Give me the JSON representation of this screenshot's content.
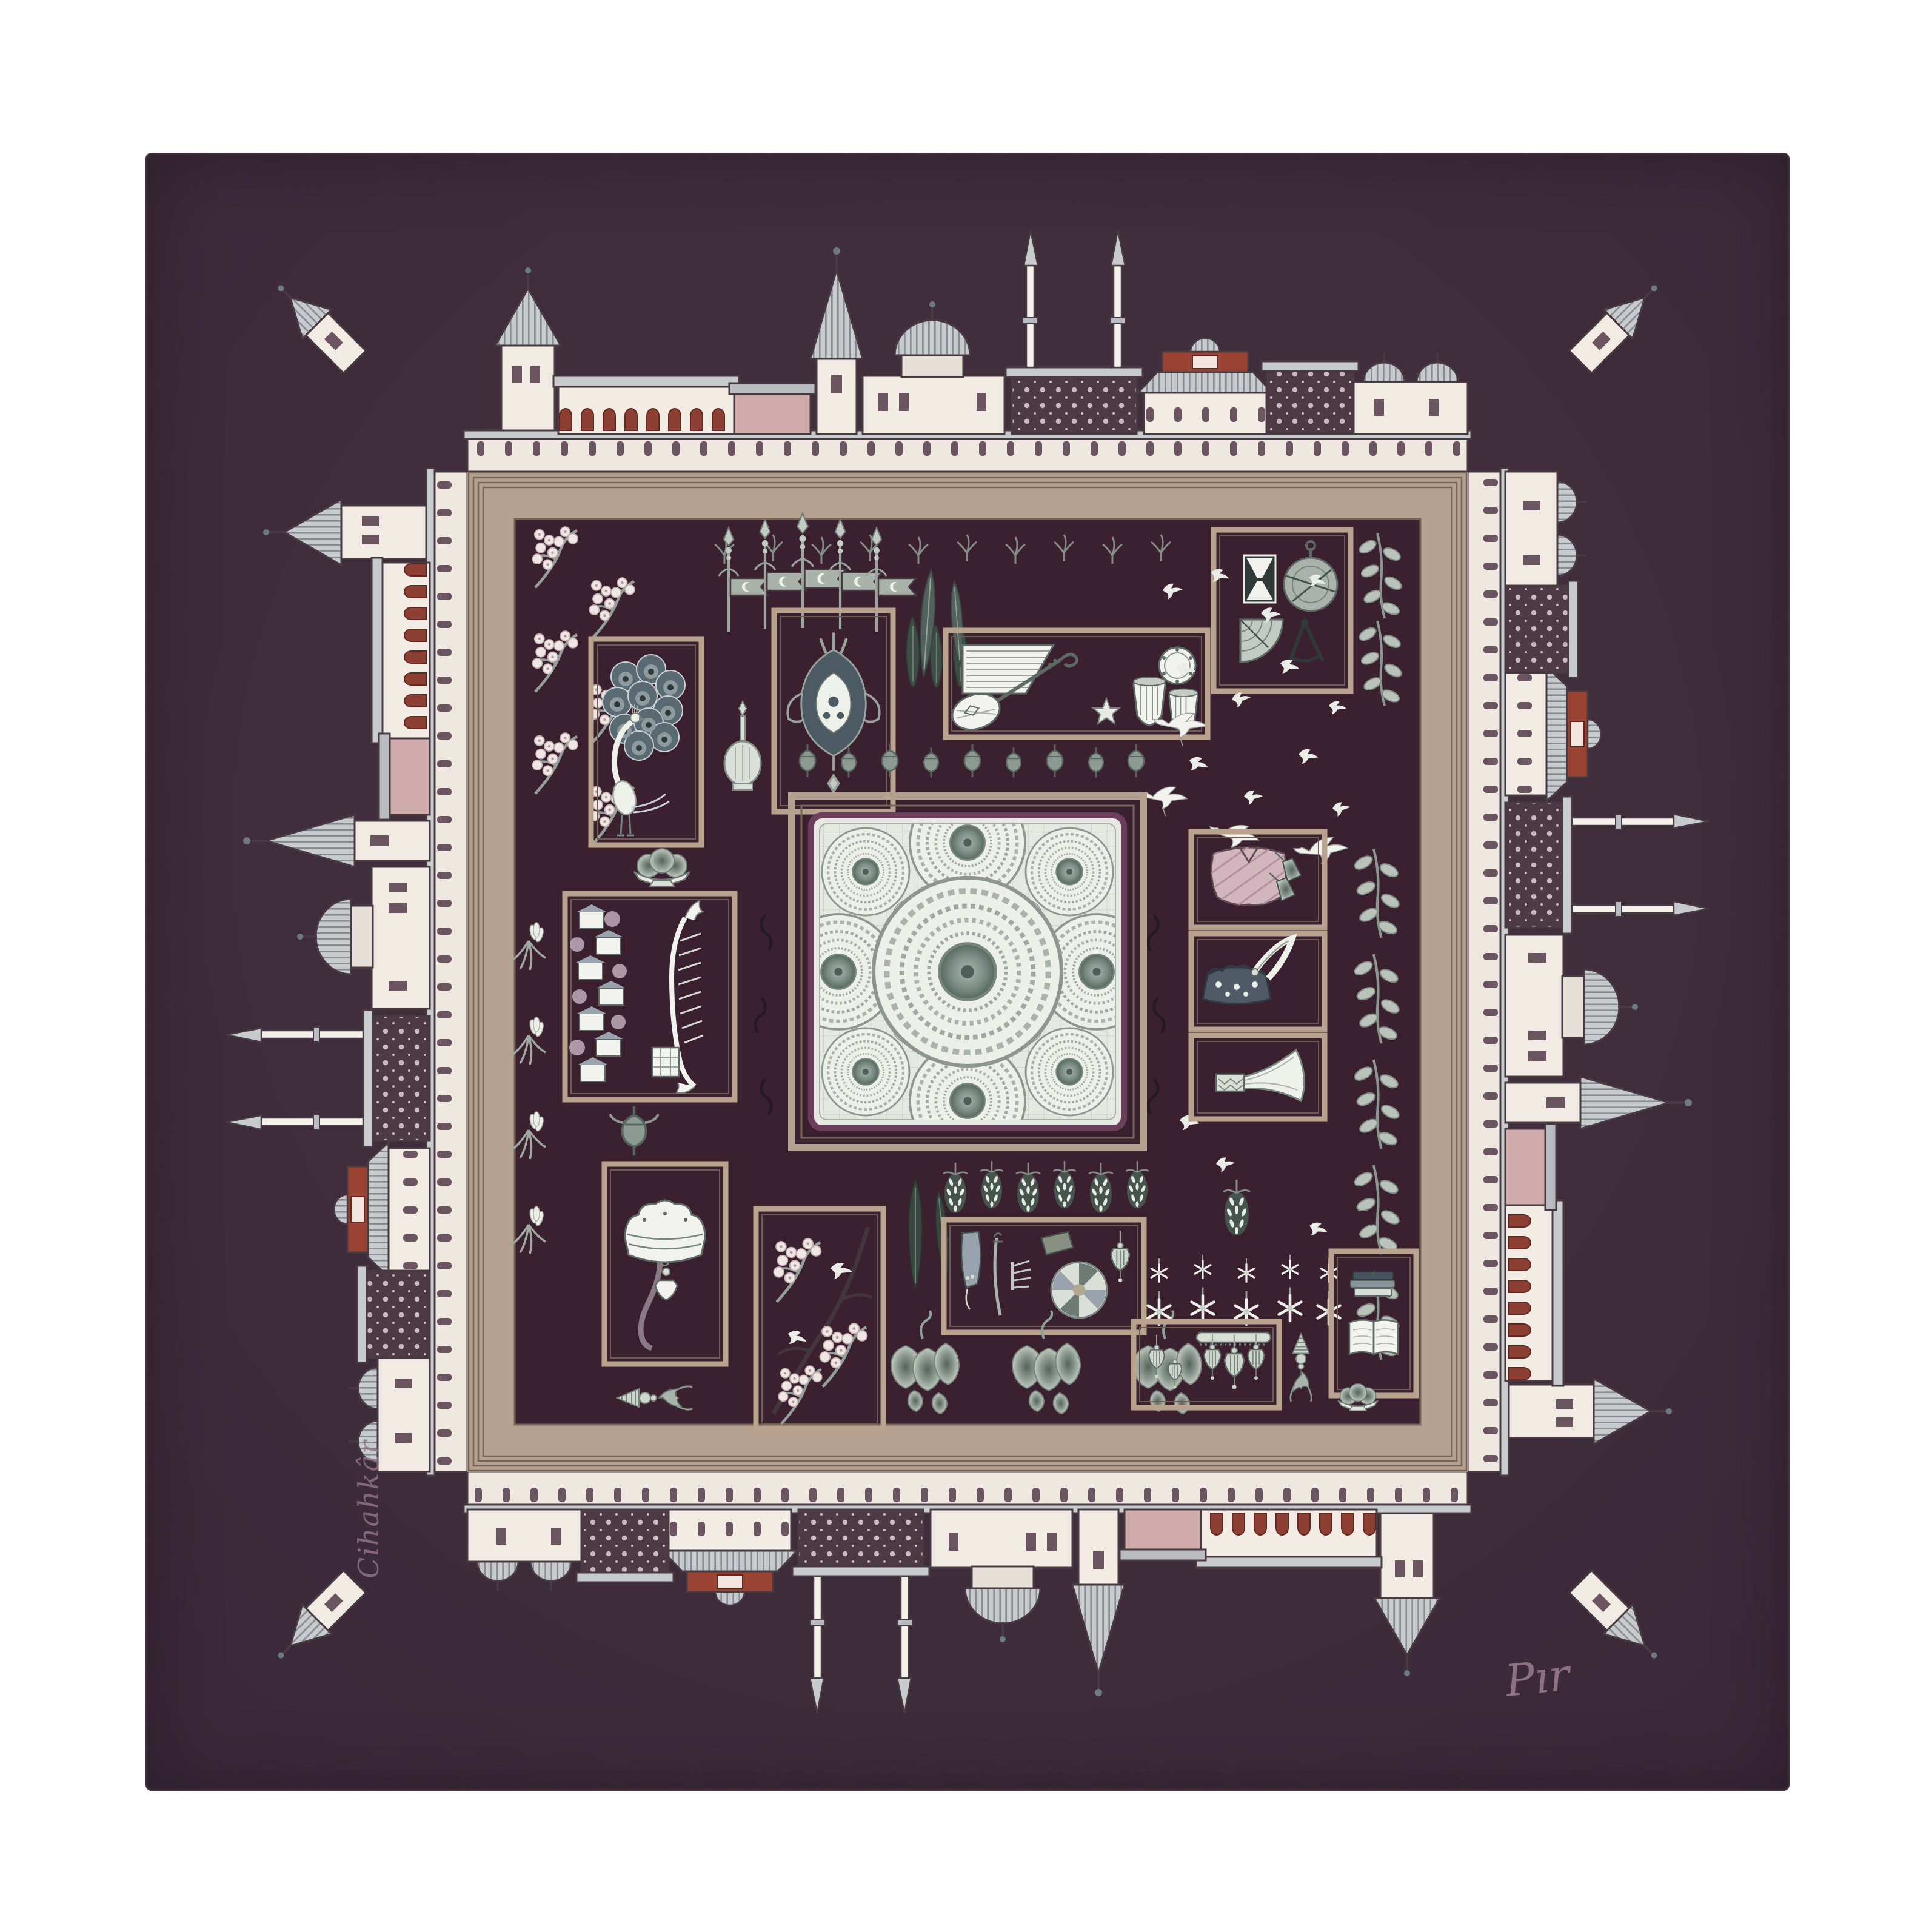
{
  "page": {
    "background_color": "#ffffff",
    "subject": "Product photograph of a square silk twill scarf laid flat on a white background",
    "theme": "Ottoman Istanbul miniature print: palace architecture border, framed Topkapi motifs, central dome-mosaic medallion"
  },
  "scarf": {
    "base_color": "#3f2d3b",
    "inner_field_color": "#3a2230",
    "frame_color": "#b5a090",
    "frame_line_color": "#776557",
    "palette": {
      "ivory": "#f1ebe3",
      "roof_grey": "#c7cbce",
      "outline": "#473a40",
      "dusty_pink": "#cfabab",
      "brick_red": "#9c4434",
      "dark_lattice": "#4e3a45",
      "pale_motif": "#e9ece5",
      "sage_grey": "#9aa59d",
      "teal_core": "#5d716b",
      "signature_mauve": "#96798c",
      "medallion_border_purple": "#6b3f5c",
      "medallion_field": "#e6e8e2"
    },
    "border_architecture": [
      "conical-roof towers",
      "pencil minarets",
      "ribbed domes",
      "tiled kiosks",
      "arched arcades",
      "brick half-dome",
      "lattice facades"
    ],
    "motif_boxes": [
      "peacock",
      "tulip-palmette-medallion",
      "musical-instruments",
      "astronomy-instruments",
      "kaftan-robe",
      "crown-with-aigrette",
      "ceremonial-horn",
      "bosphorus-waterfront-and-caique",
      "fountain-canopy",
      "spring-blossom-and-birds",
      "weapons-and-pinwheel",
      "mosque-lamps",
      "books"
    ],
    "scatter_motifs": [
      "blossom-sprigs",
      "ottoman-standards-with-crescent-flags",
      "cypress-trees",
      "swallows",
      "cranes",
      "rose-sprigs",
      "crocus-flowers",
      "dome-buds-row",
      "hop-clusters",
      "hanging-star-flowers",
      "leaf-clusters",
      "long-leaves",
      "fruit-bowl",
      "rosewater-flask",
      "tassel-ornament",
      "small-pot"
    ],
    "medallion": {
      "dome_count": 13,
      "style": "concentric mosaic dome circles seen from below"
    },
    "signatures": {
      "bottom_right": "Pır",
      "side_vertical": "Cihahkâr"
    }
  }
}
